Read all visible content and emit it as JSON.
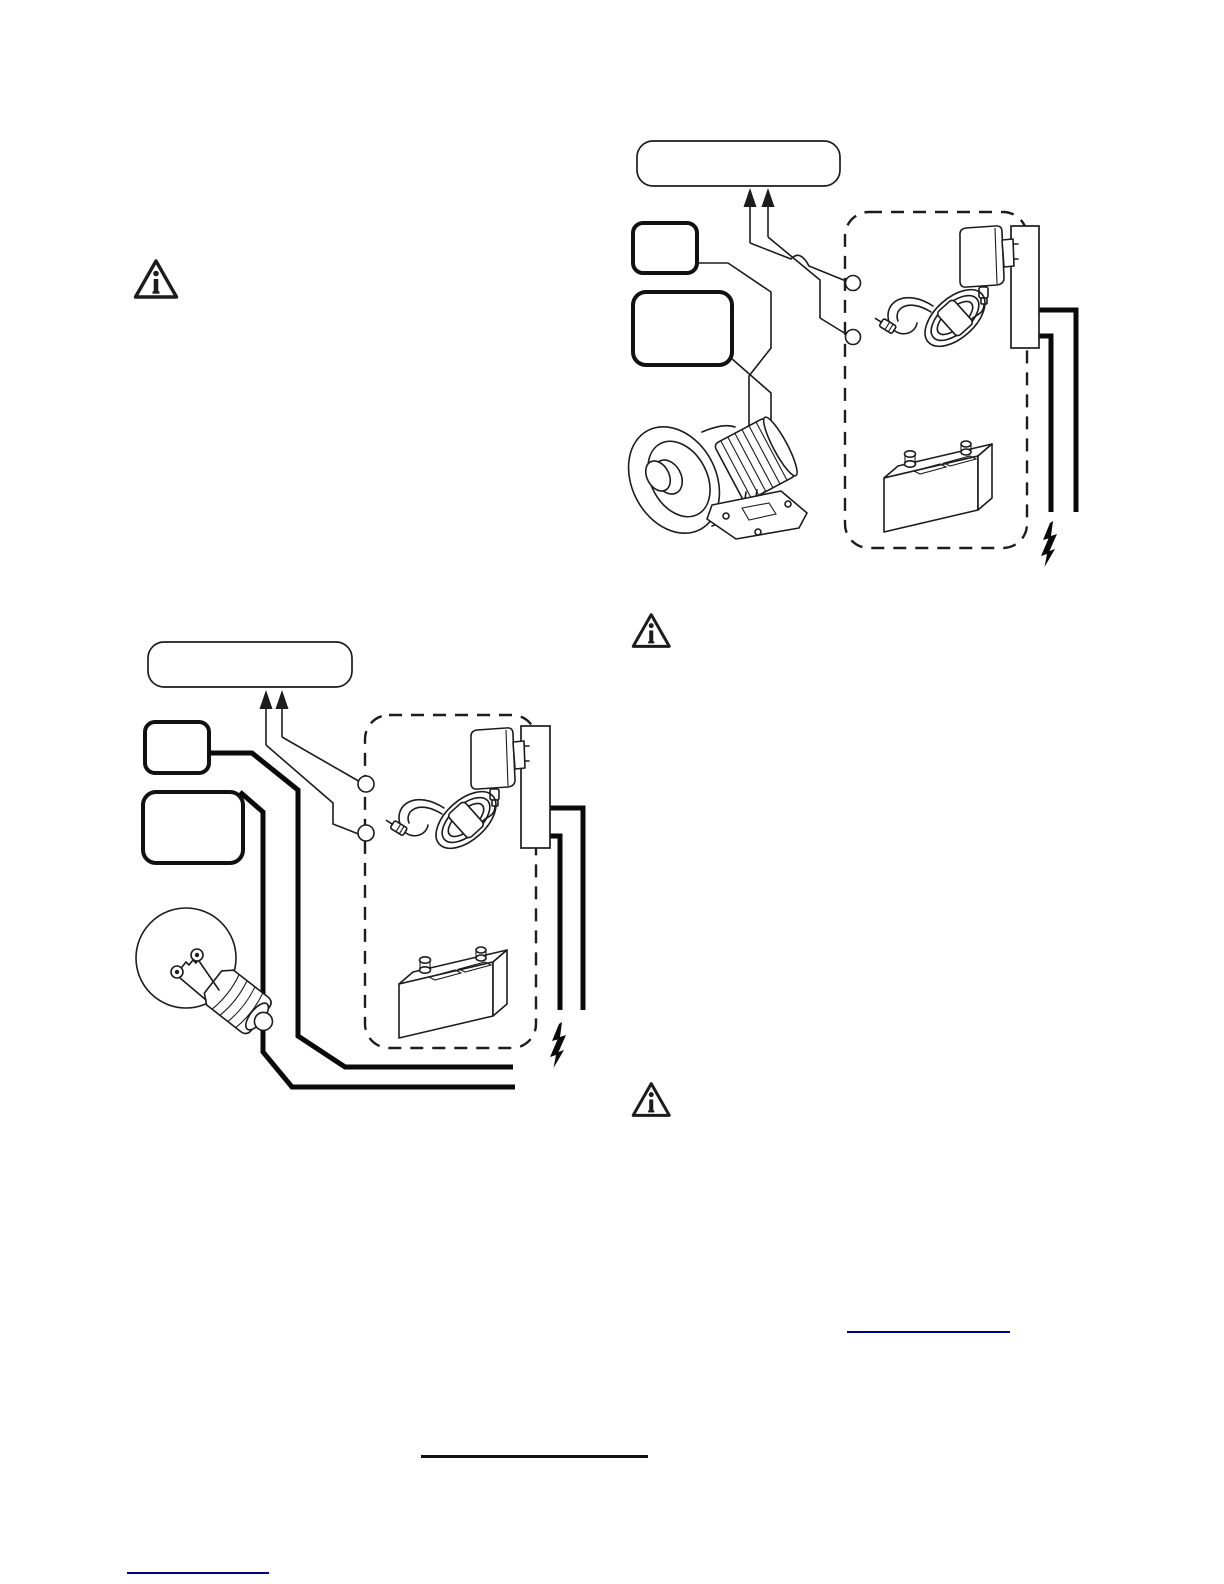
{
  "page": {
    "background": "#ffffff",
    "ink_color": "#1c1c1c",
    "link_color": "#00008b"
  },
  "warning_icons": {
    "glyph": "info-triangle",
    "count": 3
  },
  "diagrams": {
    "siren": {
      "labels": {
        "title_box": "",
        "small_callout_box": "",
        "large_callout_box": ""
      },
      "terminal_count": 2,
      "components": [
        "callout-title-box",
        "callout-small-box",
        "callout-large-box",
        "up-arrows",
        "wire-hop",
        "terminal-circles",
        "horn-siren",
        "dashed-power-region",
        "ac-adapter",
        "coiled-cord",
        "barrel-plug",
        "outlet-strip",
        "battery",
        "lightning-bolt"
      ]
    },
    "bulb": {
      "labels": {
        "title_box": "",
        "small_callout_box": "",
        "large_callout_box": ""
      },
      "terminal_count": 2,
      "components": [
        "callout-title-box",
        "callout-small-box",
        "callout-large-box",
        "up-arrows",
        "terminal-circles",
        "light-bulb",
        "dashed-power-region",
        "ac-adapter",
        "coiled-cord",
        "barrel-plug",
        "outlet-strip",
        "battery",
        "lightning-bolt"
      ]
    }
  },
  "rules_and_links": {
    "footnote_link_right": {
      "text": "",
      "color": "#00008b"
    },
    "heading_underline_center": {
      "text": "",
      "color": "#111111"
    },
    "footnote_link_bottom_left": {
      "text": "",
      "color": "#00008b"
    }
  }
}
